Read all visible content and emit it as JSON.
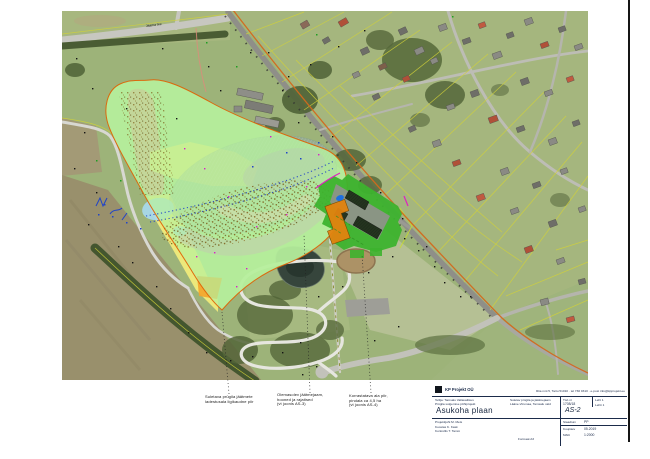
{
  "sheet": {
    "right_border_color": "#151515",
    "background": "#ffffff"
  },
  "map": {
    "road_label": "Jaama tee",
    "legend_colors": {
      "deposit_area_green": "#b6f09c",
      "slope_strip_salmon": "#e69490",
      "cover_area_yellow": "#f7ef7b",
      "access_patch_orange": "#f2a52c",
      "water_zone_grayblue": "#8fa6b2",
      "violet_zone": "#b87fd6",
      "magenta_band": "#e26ae2",
      "pink_band": "#f4b3c2",
      "light_blue_zone": "#a9d9ee",
      "facility_lawn_green": "#3db32e",
      "facility_building_orange": "#e2830f",
      "boundary_orange_line": "#e05e00",
      "route_orange_line": "#d2691e",
      "boundary_magenta_line": "#e020c0",
      "contour_blue_dots": "#2043c8",
      "cadastre_yellow_line": "#d2d238"
    }
  },
  "annotations": {
    "caption1": {
      "lines": [
        "Suletava prügila jäätmete",
        "ladestusala ligikaudne piir"
      ]
    },
    "caption2": {
      "lines": [
        "Olemasolev jäätmejaam,",
        "hooned ja rajatised",
        "(vt joonis AS-3)"
      ]
    },
    "caption3": {
      "lines": [
        "Korrastatava ala piir,",
        "pindala ca 4,5 ha",
        "(vt joonis AS-4)"
      ]
    }
  },
  "title_block": {
    "company": "KP Projekt OÜ",
    "company_info": "Riia mnt 5, Tartu 51010 · tel 730 0310 · e-post info@kpprojekt.ee",
    "client_line": "Tellija: Tamsalu Vallavalitsus",
    "project_line": "Prügila sulgemise põhiprojekt",
    "location_line1": "Suletav prügila ja jäätmejaam",
    "location_line2": "Lääne-Virumaa, Tamsalu vald",
    "work_no_label": "Töö nr",
    "work_no": "1708/18",
    "sheet_label": "Leht",
    "sheet_no": "1",
    "sheets_label": "Lehti",
    "sheets_no": "1",
    "title": "Asukoha plaan",
    "drawing_no": "AS-2",
    "staff_line1": "Projektijuht   M. Mets",
    "staff_line2": "Koostas   K. Kask",
    "staff_line3": "Kontrollis   T. Tamm",
    "format_note": "Formaat A3",
    "stage_label": "Staadium",
    "stage": "PP",
    "date_label": "Kuupäev",
    "date": "05.2019",
    "scale_label": "Mõõt",
    "scale": "1:2000"
  }
}
